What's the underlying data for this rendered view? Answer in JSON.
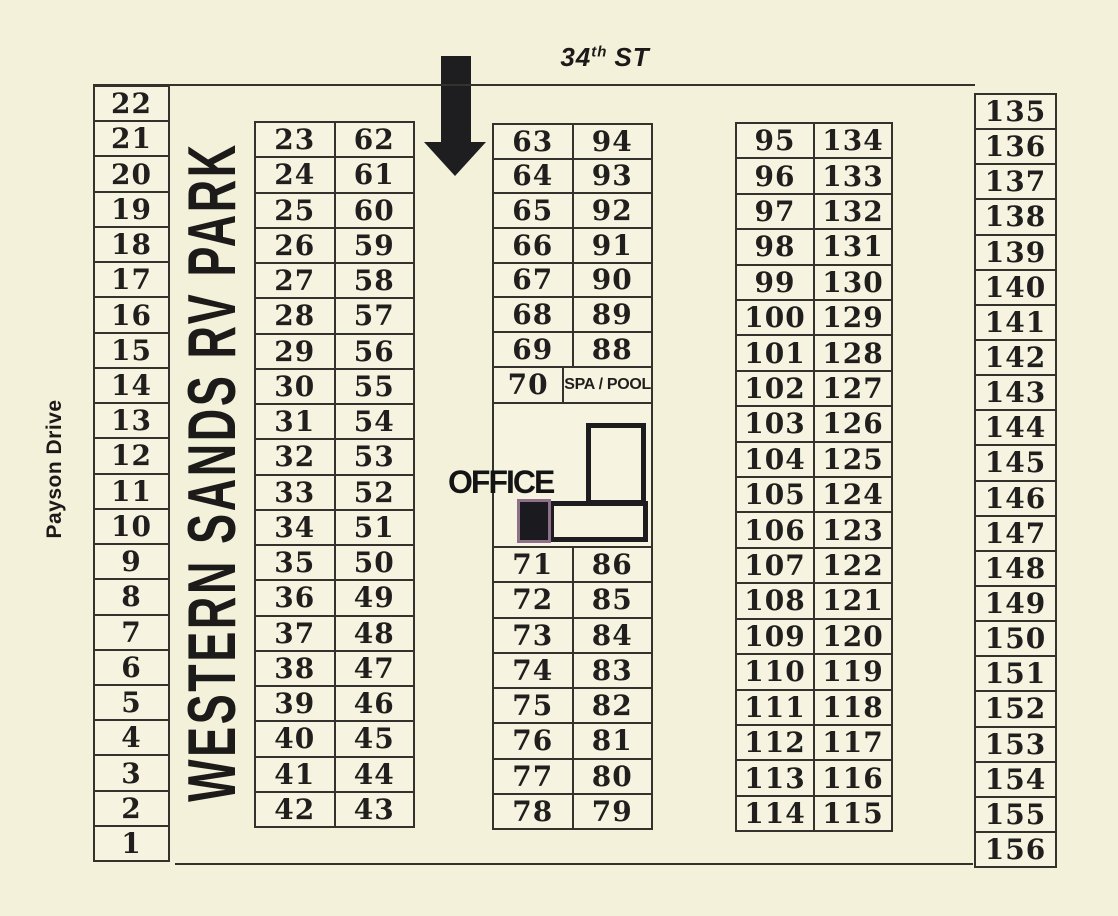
{
  "streets": {
    "top_num": "34",
    "top_sup": "th",
    "top_rest": "ST",
    "left": "Payson Drive"
  },
  "park_name": "WESTERN SANDS RV PARK",
  "office": {
    "label": "OFFICE"
  },
  "spa_row": {
    "lot": "70",
    "label": "SPA / POOL"
  },
  "lots": {
    "left_column": [
      "22",
      "21",
      "20",
      "19",
      "18",
      "17",
      "16",
      "15",
      "14",
      "13",
      "12",
      "11",
      "10",
      "9",
      "8",
      "7",
      "6",
      "5",
      "4",
      "3",
      "2",
      "1"
    ],
    "col2_rows": [
      [
        "23",
        "62"
      ],
      [
        "24",
        "61"
      ],
      [
        "25",
        "60"
      ],
      [
        "26",
        "59"
      ],
      [
        "27",
        "58"
      ],
      [
        "28",
        "57"
      ],
      [
        "29",
        "56"
      ],
      [
        "30",
        "55"
      ],
      [
        "31",
        "54"
      ],
      [
        "32",
        "53"
      ],
      [
        "33",
        "52"
      ],
      [
        "34",
        "51"
      ],
      [
        "35",
        "50"
      ],
      [
        "36",
        "49"
      ],
      [
        "37",
        "48"
      ],
      [
        "38",
        "47"
      ],
      [
        "39",
        "46"
      ],
      [
        "40",
        "45"
      ],
      [
        "41",
        "44"
      ],
      [
        "42",
        "43"
      ]
    ],
    "col3_top_rows": [
      [
        "63",
        "94"
      ],
      [
        "64",
        "93"
      ],
      [
        "65",
        "92"
      ],
      [
        "66",
        "91"
      ],
      [
        "67",
        "90"
      ],
      [
        "68",
        "89"
      ],
      [
        "69",
        "88"
      ]
    ],
    "col3_bottom_rows": [
      [
        "71",
        "86"
      ],
      [
        "72",
        "85"
      ],
      [
        "73",
        "84"
      ],
      [
        "74",
        "83"
      ],
      [
        "75",
        "82"
      ],
      [
        "76",
        "81"
      ],
      [
        "77",
        "80"
      ],
      [
        "78",
        "79"
      ]
    ],
    "col4_rows": [
      [
        "95",
        "134"
      ],
      [
        "96",
        "133"
      ],
      [
        "97",
        "132"
      ],
      [
        "98",
        "131"
      ],
      [
        "99",
        "130"
      ],
      [
        "100",
        "129"
      ],
      [
        "101",
        "128"
      ],
      [
        "102",
        "127"
      ],
      [
        "103",
        "126"
      ],
      [
        "104",
        "125"
      ],
      [
        "105",
        "124"
      ],
      [
        "106",
        "123"
      ],
      [
        "107",
        "122"
      ],
      [
        "108",
        "121"
      ],
      [
        "109",
        "120"
      ],
      [
        "110",
        "119"
      ],
      [
        "111",
        "118"
      ],
      [
        "112",
        "117"
      ],
      [
        "113",
        "116"
      ],
      [
        "114",
        "115"
      ]
    ],
    "right_column": [
      "135",
      "136",
      "137",
      "138",
      "139",
      "140",
      "141",
      "142",
      "143",
      "144",
      "145",
      "146",
      "147",
      "148",
      "149",
      "150",
      "151",
      "152",
      "153",
      "154",
      "155",
      "156"
    ]
  },
  "colors": {
    "bg": "#f3f1d9",
    "cell-bg": "#f6f4e0",
    "line": "#34322c",
    "ink": "#201f1d",
    "building": "#1d1d1f",
    "square-border": "#8e7089"
  }
}
